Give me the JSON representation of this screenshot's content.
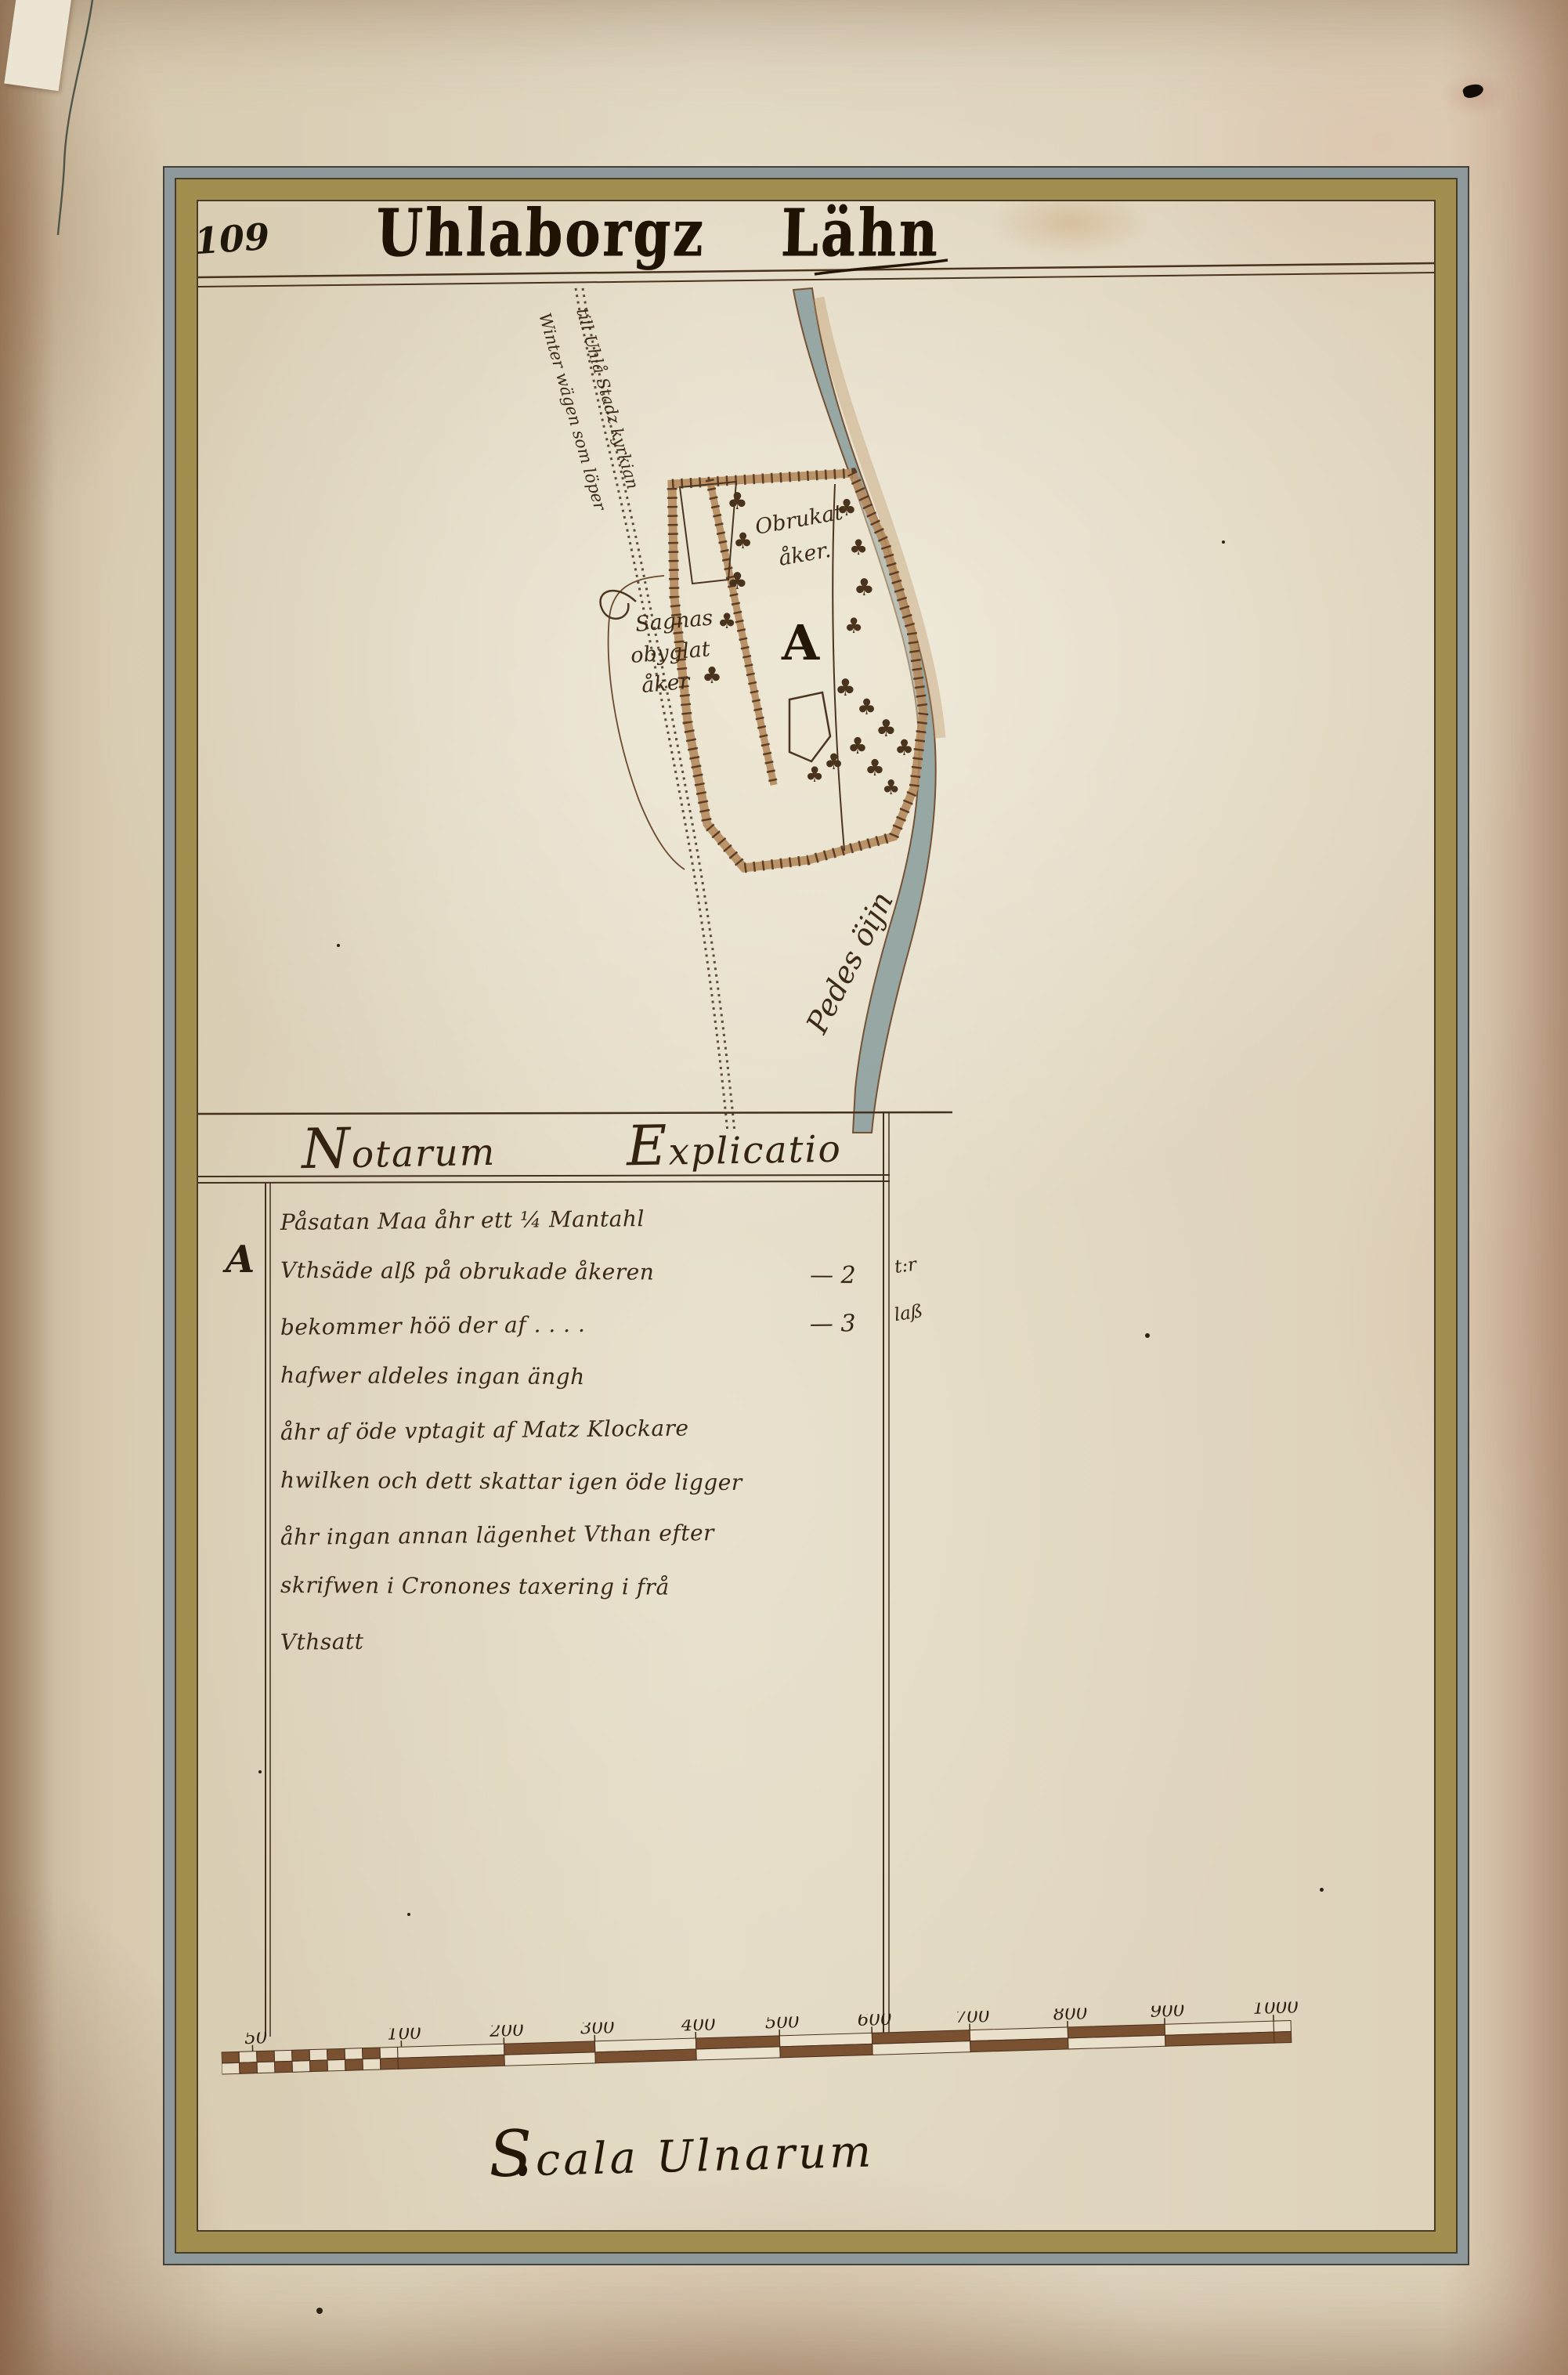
{
  "page": {
    "folio_number": "109",
    "title": "Uhlaborgz Lähn"
  },
  "map": {
    "river_label": "Pedes öijn",
    "road_label_line1": "Winter wägen som löper",
    "road_label_line2": "till Uhlå Stadz kyrkian",
    "plot_letter": "A",
    "field_label_line1": "Obrukat",
    "field_label_line2": "åker.",
    "west_field_label_line1": "Sagnas",
    "west_field_label_line2": "obyglat",
    "west_field_label_line3": "åker",
    "tree_glyph": "♣"
  },
  "notarum": {
    "header_left": "Notarum",
    "header_right": "Explicatio",
    "row_letter": "A",
    "lines": [
      {
        "text": "Påsatan Maa åhr ett ¼ Mantahl"
      },
      {
        "text": "Vthsäde alß på obrukade åkeren",
        "dash": "— 2",
        "unit": "t:r"
      },
      {
        "text": "bekommer höö der af . . . .",
        "dash": "— 3",
        "unit": "laß"
      },
      {
        "text": "hafwer aldeles ingan ängh"
      },
      {
        "text": "åhr af öde vptagit af Matz Klockare"
      },
      {
        "text": "hwilken och dett skattar igen öde ligger"
      },
      {
        "text": "åhr ingan annan lägenhet Vthan efter"
      },
      {
        "text": "skrifwen i Cronones taxering i frå"
      },
      {
        "text": "Vthsatt"
      }
    ]
  },
  "scale": {
    "tick_labels": [
      "50",
      "100",
      "200",
      "300",
      "400",
      "500",
      "600",
      "700",
      "800",
      "900",
      "1000"
    ],
    "caption": "Scala Ulnarum"
  },
  "colors": {
    "ink": "#3a2a18",
    "river_fill": "#92a4a2",
    "fence_band": "#b5895c",
    "frame_gold": "#a28e4e",
    "frame_slate": "#8d999a",
    "paper": "#ded2ba"
  }
}
